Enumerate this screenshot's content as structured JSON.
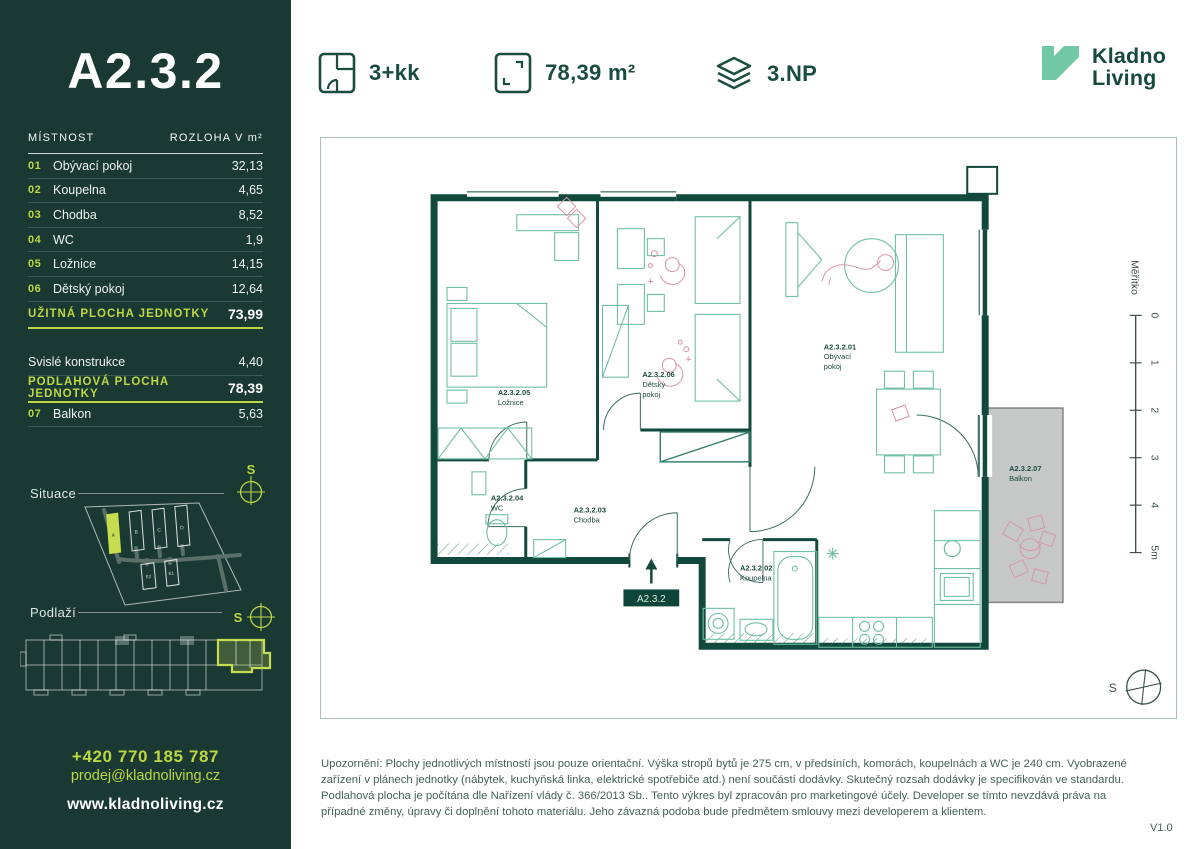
{
  "sidebar": {
    "unit_title": "A2.3.2",
    "table": {
      "col_room": "MÍSTNOST",
      "col_area": "ROZLOHA V m²",
      "rows": [
        {
          "num": "01",
          "name": "Obývací pokoj",
          "area": "32,13"
        },
        {
          "num": "02",
          "name": "Koupelna",
          "area": "4,65"
        },
        {
          "num": "03",
          "name": "Chodba",
          "area": "8,52"
        },
        {
          "num": "04",
          "name": "WC",
          "area": "1,9"
        },
        {
          "num": "05",
          "name": "Ložnice",
          "area": "14,15"
        },
        {
          "num": "06",
          "name": "Dětský pokoj",
          "area": "12,64"
        }
      ],
      "usable_label": "UŽITNÁ PLOCHA JEDNOTKY",
      "usable_value": "73,99",
      "vertical_label": "Svislé konstrukce",
      "vertical_value": "4,40",
      "floor_area_label": "PODLAHOVÁ PLOCHA JEDNOTKY",
      "floor_area_value": "78,39",
      "balcony_num": "07",
      "balcony_name": "Balkon",
      "balcony_value": "5,63"
    },
    "situace_label": "Situace",
    "podlazi_label": "Podlaží",
    "compass_letter": "S",
    "site_buildings": [
      "A",
      "B",
      "C",
      "D",
      "E2",
      "E1"
    ],
    "contact": {
      "phone": "+420 770 185 787",
      "email": "prodej@kladnoliving.cz",
      "web": "www.kladnoliving.cz"
    }
  },
  "header": {
    "disposition": "3+kk",
    "area": "78,39 m²",
    "floor": "3.NP",
    "brand_line1": "Kladno",
    "brand_line2": "Living"
  },
  "plan": {
    "rooms": [
      {
        "code": "A2.3.2.01",
        "line1": "Obývací",
        "line2": "pokoj"
      },
      {
        "code": "A2.3.2.02",
        "line1": "Koupelna",
        "line2": ""
      },
      {
        "code": "A2.3.2.03",
        "line1": "Chodba",
        "line2": ""
      },
      {
        "code": "A2.3.2.04",
        "line1": "WC",
        "line2": ""
      },
      {
        "code": "A2.3.2.05",
        "line1": "Ložnice",
        "line2": ""
      },
      {
        "code": "A2.3.2.06",
        "line1": "Dětský",
        "line2": "pokoj"
      },
      {
        "code": "A2.3.2.07",
        "line1": "Balkon",
        "line2": ""
      }
    ],
    "entrance_badge": "A2.3.2",
    "scale": {
      "label": "Měřítko",
      "ticks": [
        "0",
        "1",
        "2",
        "3",
        "4",
        "5m"
      ]
    },
    "compass_letter": "S"
  },
  "footer": {
    "disclaimer": "Upozornění: Plochy jednotlivých místností jsou pouze orientační. Výška stropů bytů je 275 cm, v předsíních, komorách, koupelnách a WC je 240 cm. Vyobrazené zařízení v plánech jednotky (nábytek, kuchyňská linka, elektrické spotřebiče atd.) není součástí dodávky. Skutečný rozsah dodávky je specifikován ve standardu. Podlahová plocha je počítána dle Nařízení vlády č. 366/2013 Sb.. Tento výkres byl zpracován pro marketingové účely. Developer se tímto nevzdává práva na případné změny, úpravy či doplnění tohoto materiálu. Jeho závazná podoba bude předmětem smlouvy mezi developerem a klientem.",
    "version": "V1.0"
  },
  "colors": {
    "accent_lime": "#bdd643",
    "sidebar_green": "#1a3932",
    "brand_green": "#1a4c3f",
    "logo_mint": "#72c7a4",
    "wall_teal": "#11493c",
    "furniture_teal": "#6fbfa4",
    "figure_pink": "#d795a8",
    "balcony_gray": "#c6c8c7"
  }
}
